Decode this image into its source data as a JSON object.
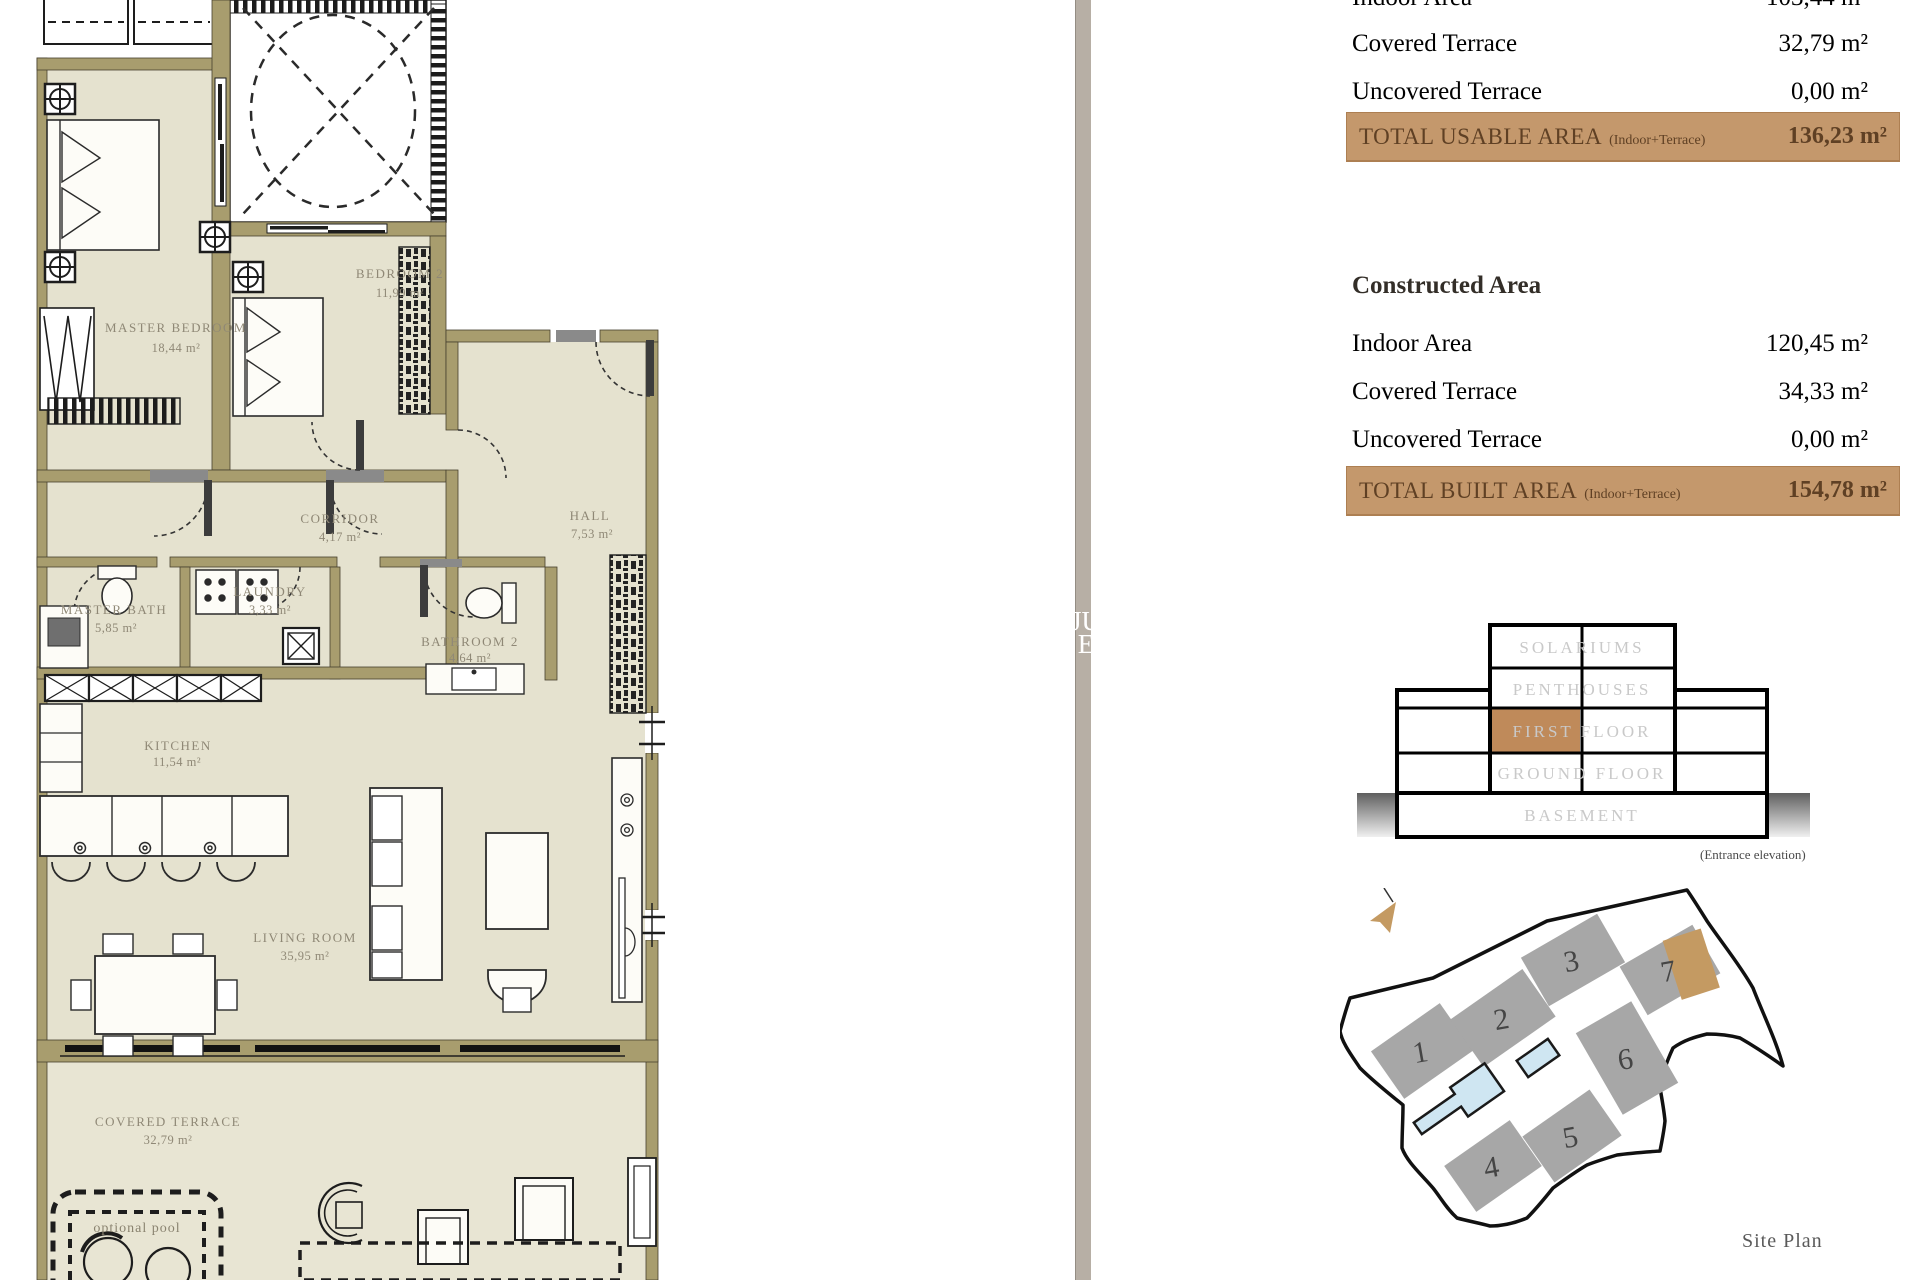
{
  "floorplan": {
    "rooms": [
      {
        "name": "MASTER BEDROOM",
        "area": "18,44 m²"
      },
      {
        "name": "BEDROOM 2",
        "area": "11,99 m²"
      },
      {
        "name": "CORRIDOR",
        "area": "4,17 m²"
      },
      {
        "name": "HALL",
        "area": "7,53 m²"
      },
      {
        "name": "MASTER BATH",
        "area": "5,85 m²"
      },
      {
        "name": "LAUNDRY",
        "area": "3,33 m²"
      },
      {
        "name": "BATHROOM 2",
        "area": "4,64 m²"
      },
      {
        "name": "KITCHEN",
        "area": "11,54 m²"
      },
      {
        "name": "LIVING ROOM",
        "area": "35,95 m²"
      },
      {
        "name": "COVERED TERRACE",
        "area": "32,79 m²"
      }
    ],
    "pool_label": "optional pool"
  },
  "watermark": {
    "line1": "JU",
    "line2": "E"
  },
  "usable_area": {
    "rows": [
      {
        "label": "Indoor Area",
        "value": "103,44 m²"
      },
      {
        "label": "Covered Terrace",
        "value": "32,79 m²"
      },
      {
        "label": "Uncovered Terrace",
        "value": "0,00 m²"
      }
    ],
    "total": {
      "label": "TOTAL USABLE AREA",
      "note": "(Indoor+Terrace)",
      "value": "136,23 m²"
    }
  },
  "constructed_area": {
    "heading": "Constructed Area",
    "rows": [
      {
        "label": "Indoor Area",
        "value": "120,45 m²"
      },
      {
        "label": "Covered Terrace",
        "value": "34,33 m²"
      },
      {
        "label": "Uncovered Terrace",
        "value": "0,00 m²"
      }
    ],
    "total": {
      "label": "TOTAL BUILT AREA",
      "note": "(Indoor+Terrace)",
      "value": "154,78 m²"
    }
  },
  "elevation": {
    "floors": [
      "SOLARIUMS",
      "PENTHOUSES",
      "FIRST FLOOR",
      "GROUND FLOOR",
      "BASEMENT"
    ],
    "caption": "(Entrance elevation)",
    "highlight_color": "#bf8a5a"
  },
  "siteplan": {
    "buildings": [
      "1",
      "2",
      "3",
      "4",
      "5",
      "6",
      "7"
    ],
    "caption": "Site Plan",
    "highlighted_building": "7"
  },
  "colors": {
    "wall": "#a89d6e",
    "room": "#e5e2cf",
    "band": "#c4986c",
    "building_gray": "#a7a7a7",
    "accent_tan": "#c49a62",
    "pool_blue": "#cfe6f2"
  }
}
